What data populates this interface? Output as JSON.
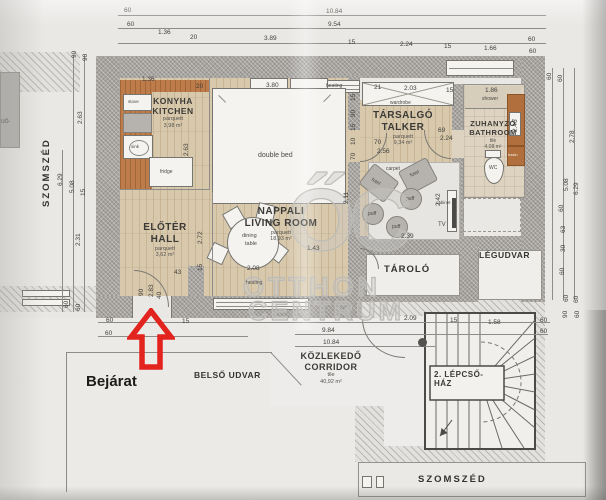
{
  "colors": {
    "arrow_red": "#e3231e",
    "wall_gray": "#a7a4a0",
    "parquet": "#d8c9ad",
    "kitchen_wood": "#bd7c49",
    "tile": "#ddd3c0",
    "watermark_gray": "#bcbbb7",
    "paper": "#e9e8e5"
  },
  "site_labels": {
    "szomszed_left": "SZOMSZÉD",
    "szomszed_bottom": "SZOMSZÉD",
    "belso_udvar": "BELSŐ UDVAR",
    "bejarat": "Bejárat",
    "tarolo": "TÁROLÓ",
    "legudvar": "LÉGUDVAR",
    "edge_text": "UŐ-"
  },
  "rooms": {
    "kitchen": {
      "hu": "KONYHA",
      "en": "KITCHEN",
      "floor": "parquett",
      "area": "3,98 m²"
    },
    "living": {
      "hu": "NAPPALI",
      "en": "LIVING ROOM",
      "floor": "parquett",
      "area": "18,93 m²"
    },
    "hall": {
      "hu": "ELŐTÉR",
      "en": "HALL",
      "floor": "parquett",
      "area": "3,62 m²"
    },
    "talker": {
      "hu": "TÁRSALGÓ",
      "en": "TALKER",
      "floor": "parquett",
      "area": "9,34 m²"
    },
    "bathroom": {
      "hu": "ZUHANYZÓ",
      "en": "BATHROOM",
      "floor": "tile",
      "area": "4,08 m²"
    },
    "corridor": {
      "hu": "KÖZLEKEDŐ",
      "en": "CORRIDOR",
      "floor": "tile",
      "area": "40,92 m²"
    },
    "staircase": {
      "line1": "2. LÉPCSŐ-",
      "line2": "HÁZ"
    }
  },
  "furniture": {
    "double_bed": "double bed",
    "dining_l1": "dining",
    "dining_l2": "table",
    "wardrobe": "wardrobe",
    "carpet": "carpet",
    "fotel": "fotel",
    "puff": "puff",
    "tv": "TV",
    "cabinet": "cabinet",
    "shower": "shower",
    "wc": "WC",
    "basin": "basin",
    "stove": "stove",
    "sink": "sink",
    "fridge": "fridge",
    "heating": "heating"
  },
  "watermark": {
    "logo": "ŐC",
    "line1": "OTTHON",
    "line2": "CENTRUM"
  },
  "dimensions": [
    {
      "t": "60",
      "x": 124,
      "y": 8
    },
    {
      "t": "10.84",
      "x": 326,
      "y": 9
    },
    {
      "t": "60",
      "x": 127,
      "y": 22
    },
    {
      "t": "9.54",
      "x": 328,
      "y": 22
    },
    {
      "t": "1.36",
      "x": 158,
      "y": 30
    },
    {
      "t": "20",
      "x": 190,
      "y": 35
    },
    {
      "t": "3.89",
      "x": 264,
      "y": 36
    },
    {
      "t": "15",
      "x": 348,
      "y": 40
    },
    {
      "t": "2.24",
      "x": 400,
      "y": 42
    },
    {
      "t": "15",
      "x": 444,
      "y": 44
    },
    {
      "t": "1.66",
      "x": 484,
      "y": 46
    },
    {
      "t": "60",
      "x": 528,
      "y": 37
    },
    {
      "t": "60",
      "x": 529,
      "y": 49
    },
    {
      "t": "90",
      "x": 72,
      "y": 58,
      "r": -90
    },
    {
      "t": "90",
      "x": 83,
      "y": 61,
      "r": -90
    },
    {
      "t": "2.63",
      "x": 78,
      "y": 124,
      "r": -90
    },
    {
      "t": "6.29",
      "x": 58,
      "y": 186,
      "r": -90
    },
    {
      "t": "5.08",
      "x": 70,
      "y": 193,
      "r": -90
    },
    {
      "t": "15",
      "x": 81,
      "y": 196,
      "r": -90
    },
    {
      "t": "2.31",
      "x": 76,
      "y": 246,
      "r": -90
    },
    {
      "t": "60",
      "x": 64,
      "y": 308,
      "r": -90
    },
    {
      "t": "60",
      "x": 76,
      "y": 311,
      "r": -90
    },
    {
      "t": "60",
      "x": 547,
      "y": 80,
      "r": -90
    },
    {
      "t": "60",
      "x": 558,
      "y": 82,
      "r": -90
    },
    {
      "t": "2.78",
      "x": 570,
      "y": 143,
      "r": -90
    },
    {
      "t": "5.08",
      "x": 564,
      "y": 191,
      "r": -90
    },
    {
      "t": "6.29",
      "x": 574,
      "y": 195,
      "r": -90
    },
    {
      "t": "60",
      "x": 559,
      "y": 212,
      "r": -90
    },
    {
      "t": "63",
      "x": 561,
      "y": 233,
      "r": -90
    },
    {
      "t": "30",
      "x": 561,
      "y": 252,
      "r": -90
    },
    {
      "t": "60",
      "x": 560,
      "y": 275,
      "r": -90
    },
    {
      "t": "60",
      "x": 564,
      "y": 302,
      "r": -90
    },
    {
      "t": "60",
      "x": 574,
      "y": 303,
      "r": -90
    },
    {
      "t": "1.36",
      "x": 142,
      "y": 77
    },
    {
      "t": "20",
      "x": 196,
      "y": 84
    },
    {
      "t": "3.80",
      "x": 266,
      "y": 83
    },
    {
      "t": "heating",
      "x": 326,
      "y": 84,
      "s": "f5"
    },
    {
      "t": "21",
      "x": 374,
      "y": 85
    },
    {
      "t": "2.03",
      "x": 404,
      "y": 86
    },
    {
      "t": "15",
      "x": 446,
      "y": 88
    },
    {
      "t": "1.86",
      "x": 485,
      "y": 88
    },
    {
      "t": "15",
      "x": 351,
      "y": 101,
      "r": -90
    },
    {
      "t": "90",
      "x": 351,
      "y": 117,
      "r": -90
    },
    {
      "t": "15",
      "x": 351,
      "y": 131,
      "r": -90
    },
    {
      "t": "10",
      "x": 351,
      "y": 145,
      "r": -90
    },
    {
      "t": "70",
      "x": 351,
      "y": 160,
      "r": -90
    },
    {
      "t": "2.11",
      "x": 344,
      "y": 204,
      "r": -90
    },
    {
      "t": "2.63",
      "x": 184,
      "y": 156,
      "r": -90
    },
    {
      "t": "2.72",
      "x": 198,
      "y": 244,
      "r": -90
    },
    {
      "t": "15",
      "x": 198,
      "y": 271,
      "r": -90
    },
    {
      "t": "43",
      "x": 174,
      "y": 270
    },
    {
      "t": "90",
      "x": 139,
      "y": 296,
      "r": -90
    },
    {
      "t": "2.83",
      "x": 149,
      "y": 297,
      "r": -90
    },
    {
      "t": "40",
      "x": 157,
      "y": 299,
      "r": -90
    },
    {
      "t": "1.43",
      "x": 307,
      "y": 246
    },
    {
      "t": "2.08",
      "x": 247,
      "y": 266
    },
    {
      "t": "heating",
      "x": 246,
      "y": 281,
      "s": "f5"
    },
    {
      "t": "70",
      "x": 374,
      "y": 140
    },
    {
      "t": "2.56",
      "x": 377,
      "y": 149
    },
    {
      "t": "69",
      "x": 438,
      "y": 128
    },
    {
      "t": "2.24",
      "x": 440,
      "y": 136
    },
    {
      "t": "2.42",
      "x": 436,
      "y": 206,
      "r": -90
    },
    {
      "t": "2.39",
      "x": 401,
      "y": 234
    },
    {
      "t": "2.46",
      "x": 513,
      "y": 132,
      "r": -90
    },
    {
      "t": "60",
      "x": 106,
      "y": 318
    },
    {
      "t": "60",
      "x": 105,
      "y": 331
    },
    {
      "t": "15",
      "x": 182,
      "y": 319
    },
    {
      "t": "9.84",
      "x": 322,
      "y": 328
    },
    {
      "t": "10.84",
      "x": 323,
      "y": 340
    },
    {
      "t": "2.09",
      "x": 404,
      "y": 316
    },
    {
      "t": "15",
      "x": 450,
      "y": 318
    },
    {
      "t": "1.58",
      "x": 488,
      "y": 320
    },
    {
      "t": "60",
      "x": 540,
      "y": 318
    },
    {
      "t": "60",
      "x": 540,
      "y": 329
    },
    {
      "t": "90",
      "x": 563,
      "y": 318,
      "r": -90
    },
    {
      "t": "60",
      "x": 575,
      "y": 318,
      "r": -90
    }
  ]
}
